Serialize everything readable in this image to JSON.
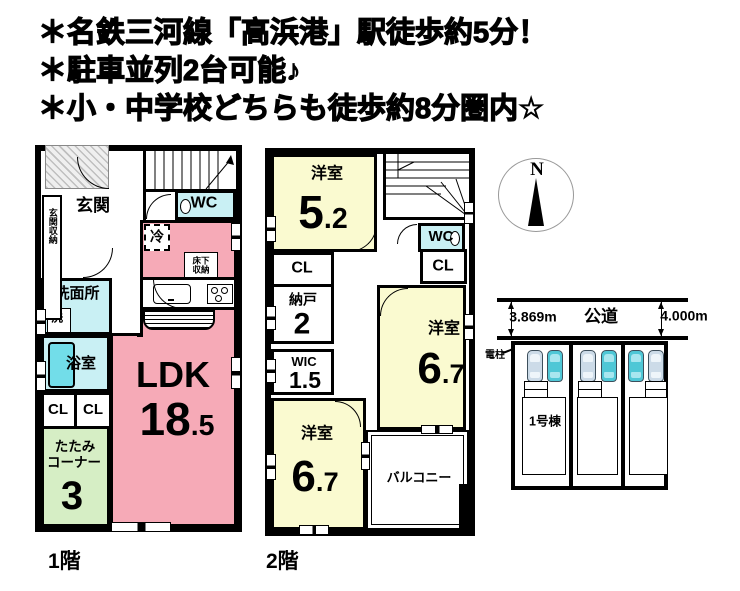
{
  "header": {
    "line1": "＊名鉄三河線「高浜港」駅徒歩約5分！",
    "line2": "＊駐車並列2台可能♪",
    "line3": "＊小・中学校どちらも徒歩約8分圏内☆"
  },
  "floor1": {
    "label": "1階",
    "entrance": "玄関",
    "entrance_storage": "玄関収納",
    "wc": "WC",
    "fridge": "冷",
    "underfloor_storage_l1": "床下",
    "underfloor_storage_l2": "収納",
    "washroom": "洗面所",
    "washer": "洗",
    "bathroom": "浴室",
    "closet1": "CL",
    "closet2": "CL",
    "tatami_l1": "たたみ",
    "tatami_l2": "コーナー",
    "tatami_size": "3",
    "ldk": "LDK",
    "ldk_size_int": "18",
    "ldk_size_dec": ".5"
  },
  "floor2": {
    "label": "2階",
    "room1": "洋室",
    "room1_size_int": "5",
    "room1_size_dec": ".2",
    "wc": "WC",
    "closet_left": "CL",
    "closet_right": "CL",
    "storeroom": "納戸",
    "storeroom_size": "2",
    "wic": "WIC",
    "wic_size": "1.5",
    "room2": "洋室",
    "room2_size_int": "6",
    "room2_size_dec": ".7",
    "room3": "洋室",
    "room3_size_int": "6",
    "room3_size_dec": ".7",
    "balcony": "バルコニー"
  },
  "compass": {
    "north_label": "N"
  },
  "site_plan": {
    "road_label": "公道",
    "frontage_left": "3.869m",
    "frontage_right": "4.000m",
    "utility_pole": "電柱",
    "building_label": "1号棟"
  },
  "colors": {
    "ldk_pink": "#f6aab7",
    "room_yellow": "#fafad0",
    "wet_cyan": "#c9f0f4",
    "tub_cyan": "#72dde9",
    "tatami_green": "#d6eec5",
    "car_teal": "#4fc7d6",
    "car_light": "#ccdbe8"
  }
}
